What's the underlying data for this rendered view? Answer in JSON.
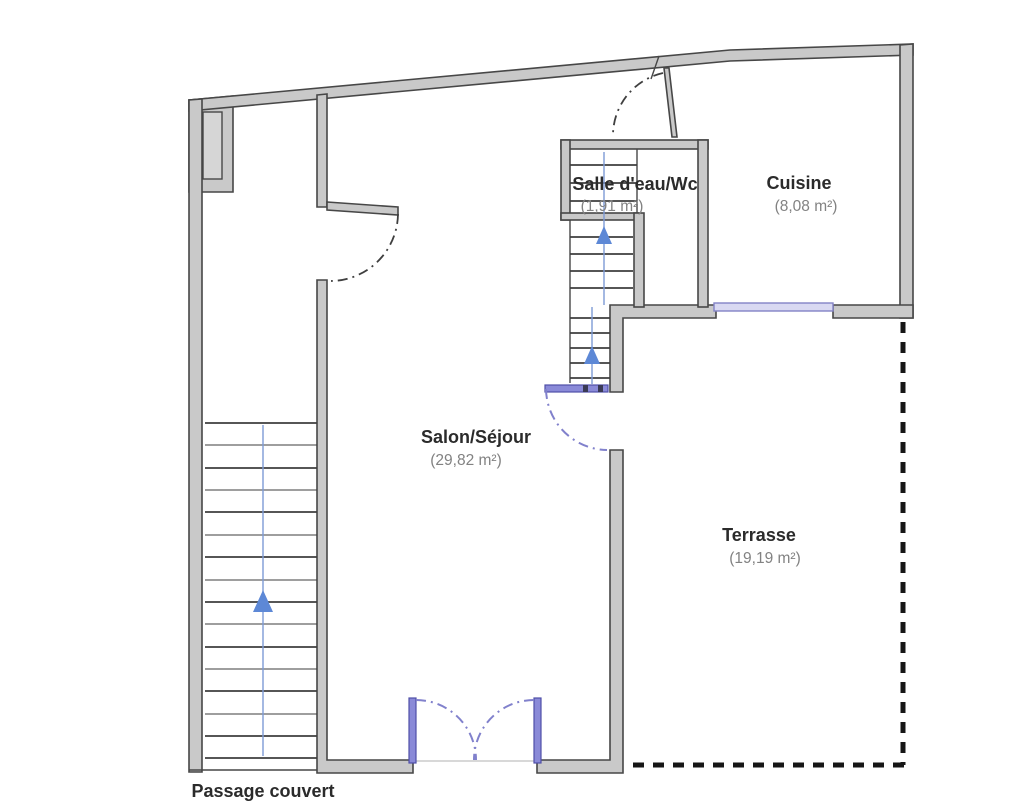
{
  "rooms": {
    "salle_deau": {
      "name": "Salle d'eau/Wc",
      "area": "(1,91 m²)"
    },
    "cuisine": {
      "name": "Cuisine",
      "area": "(8,08 m²)"
    },
    "salon": {
      "name": "Salon/Séjour",
      "area": "(29,82 m²)"
    },
    "terrasse": {
      "name": "Terrasse",
      "area": "(19,19 m²)"
    },
    "passage_couvert": {
      "name": "Passage couvert"
    }
  },
  "colors": {
    "wall_fill": "#c9c9c9",
    "wall_stroke": "#474747",
    "tread": "#3e3e3e",
    "stair_line_blue": "#7d9bd6",
    "arrow_blue": "#5d88d6",
    "arc_dark": "#3f3f3f",
    "arc_violet": "#8181cc",
    "door_blue": "#8a8ad8",
    "door_blue_stroke": "#4f4fa8",
    "window_fill": "#d9d9f2",
    "window_stroke": "#8383c6",
    "dashed_boundary": "#161616",
    "label_dark": "#2b2b2b",
    "label_gray": "#828282",
    "threshold": "#cccccc"
  }
}
